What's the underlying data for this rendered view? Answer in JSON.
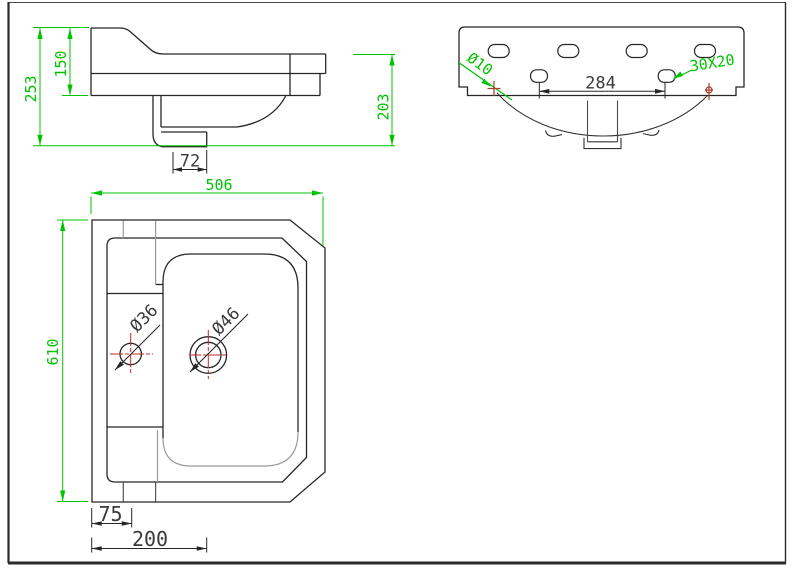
{
  "drawing_title": "wash-basin-technical-drawing",
  "colors": {
    "background": "#ffffff",
    "line": "#262626",
    "gray_line": "#9a9a9a",
    "dim_green": "#00c300",
    "dim_dark": "#3a3a3a",
    "center_red": "#c5281c",
    "mark_red": "#a83b2a"
  },
  "side_view": {
    "label": "side-elevation",
    "dims": {
      "overall_height": "253",
      "upper_height": "150",
      "trap_offset": "72",
      "depth": "203"
    }
  },
  "plan_view": {
    "label": "top-plan",
    "dims": {
      "overall_width": "506",
      "overall_depth": "610",
      "faucet_hole_dia": "Ø36",
      "drain_hole_dia": "Ø46",
      "left_offset": "75",
      "drain_offset": "200"
    }
  },
  "rear_view": {
    "label": "rear-elevation",
    "dims": {
      "fixing_hole_dia": "Ø10",
      "fixing_hole_spacing": "284",
      "slot_size": "30X20"
    }
  }
}
